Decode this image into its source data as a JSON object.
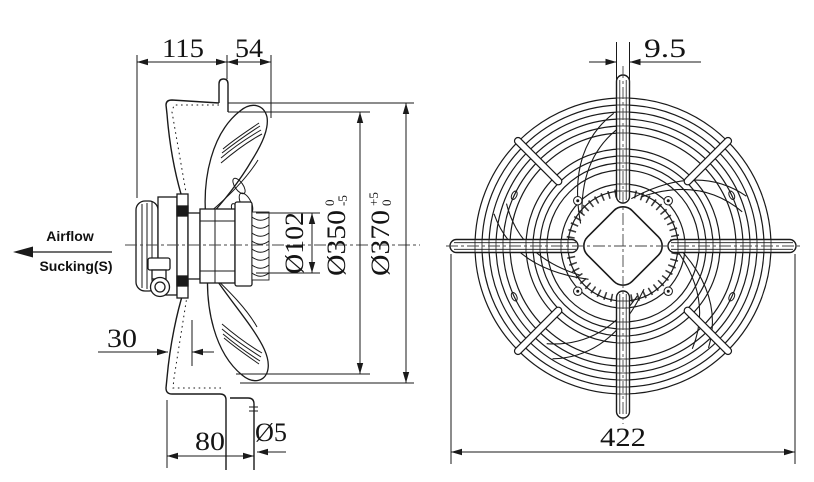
{
  "drawing": {
    "airflow_label": "Airflow",
    "airflow_sublabel": "Sucking(S)",
    "dims": {
      "d115": "115",
      "d54": "54",
      "d30": "30",
      "d80": "80",
      "d_hole": "Ø5",
      "d_hub": "Ø102",
      "d_fan": "Ø350",
      "d_fan_tol_up": "0",
      "d_fan_tol_dn": "-5",
      "d_opening": "Ø370",
      "d_open_tol_up": "+5",
      "d_open_tol_dn": "0",
      "d_strut": "9.5",
      "d_overall": "422"
    },
    "colors": {
      "line": "#1a1a1a",
      "bg": "#ffffff"
    }
  }
}
